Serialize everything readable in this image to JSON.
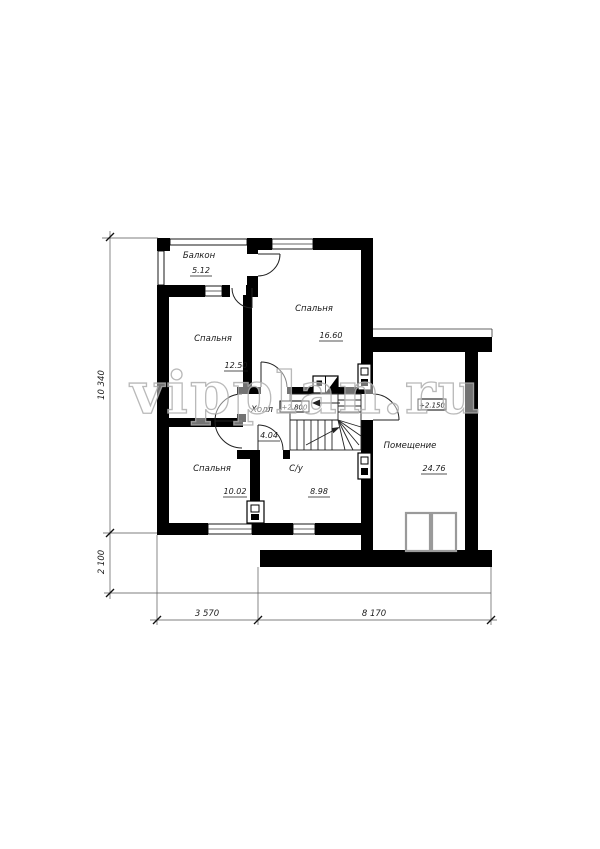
{
  "watermark": {
    "text": "vipplan.ru"
  },
  "rooms": [
    {
      "id": "balcony",
      "name": "Балкон",
      "area": "5.12"
    },
    {
      "id": "bedroom-top-right",
      "name": "Спальня",
      "area": "16.60"
    },
    {
      "id": "bedroom-left",
      "name": "Спальня",
      "area": "12.50"
    },
    {
      "id": "bedroom-bottom-left",
      "name": "Спальня",
      "area": "10.02"
    },
    {
      "id": "bathroom",
      "name": "С/у",
      "area": "8.98"
    },
    {
      "id": "hall",
      "name": "Холл",
      "area": "4.04",
      "elevation": "+2.800"
    },
    {
      "id": "room-over-garage",
      "name": "Помещение",
      "area": "24.76",
      "elevation": "+2.150"
    }
  ],
  "dimensions": {
    "left": [
      "10 340",
      "2 100"
    ],
    "bottom": [
      "3 570",
      "8 170"
    ]
  },
  "colors": {
    "wall": "#000000",
    "watermark_stroke": "#adadad"
  }
}
